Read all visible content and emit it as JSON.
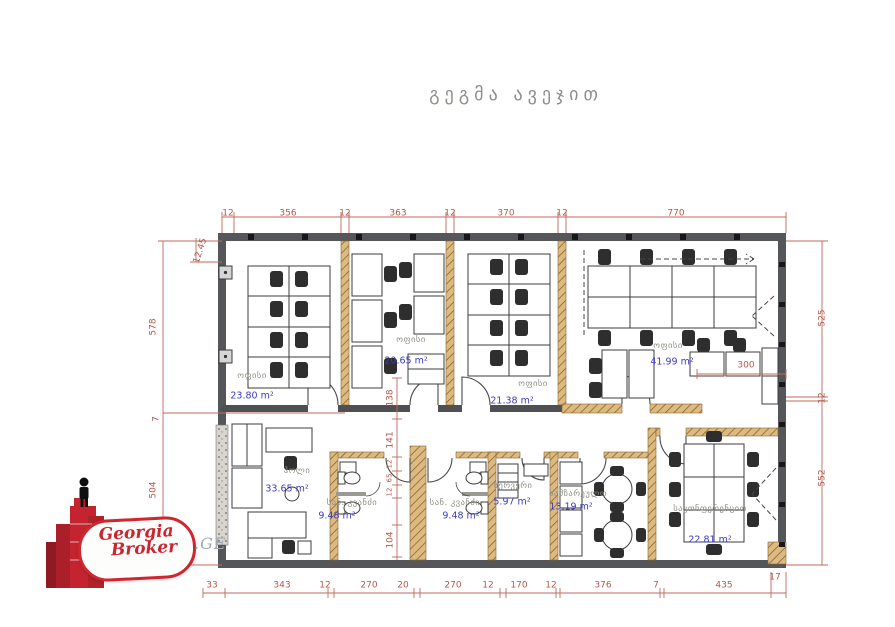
{
  "title": "გეგმა ავეჯით",
  "logo": {
    "name_line1": "Georgia",
    "name_line2": "Broker",
    "domain": ".GE"
  },
  "rooms": [
    {
      "name": "ოფისი",
      "area": "23.80 m²"
    },
    {
      "name": "ოფისი",
      "area": "20.65 m²"
    },
    {
      "name": "ოფისი",
      "area": "21.38 m²"
    },
    {
      "name": "ოფისი",
      "area": "41.99 m²"
    },
    {
      "name": "ჰოლი",
      "area": "33.65 m²"
    },
    {
      "name": "სან. კვანძი",
      "area": "9.48 m²"
    },
    {
      "name": "სან. კვანძი",
      "area": "9.48 m²"
    },
    {
      "name": "სერვერი",
      "area": "5.97 m²"
    },
    {
      "name": "სამზარეულო",
      "area": "13.19 m²"
    },
    {
      "name": "საკონფერენციო",
      "area": "22.81 m²"
    }
  ],
  "dims": {
    "top": [
      "12",
      "356",
      "12",
      "363",
      "12",
      "370",
      "12",
      "770"
    ],
    "bottom": [
      "33",
      "343",
      "12",
      "270",
      "20",
      "270",
      "12",
      "170",
      "12",
      "376",
      "7",
      "435"
    ],
    "bottom_right": "17",
    "left": [
      "12.45",
      "578",
      "7",
      "504"
    ],
    "right": [
      "525",
      "12",
      "552"
    ],
    "inner_v": [
      "138",
      "141",
      "12",
      "65",
      "12",
      "104"
    ],
    "inner_h": "300"
  },
  "colors": {
    "dimension": "#b2584a",
    "area_text": "#3b3bc2",
    "room_text": "#8f8f84",
    "wall_dark": "#55565a",
    "wall_hatch": "#ddbb80",
    "logo_red": "#c92630"
  }
}
